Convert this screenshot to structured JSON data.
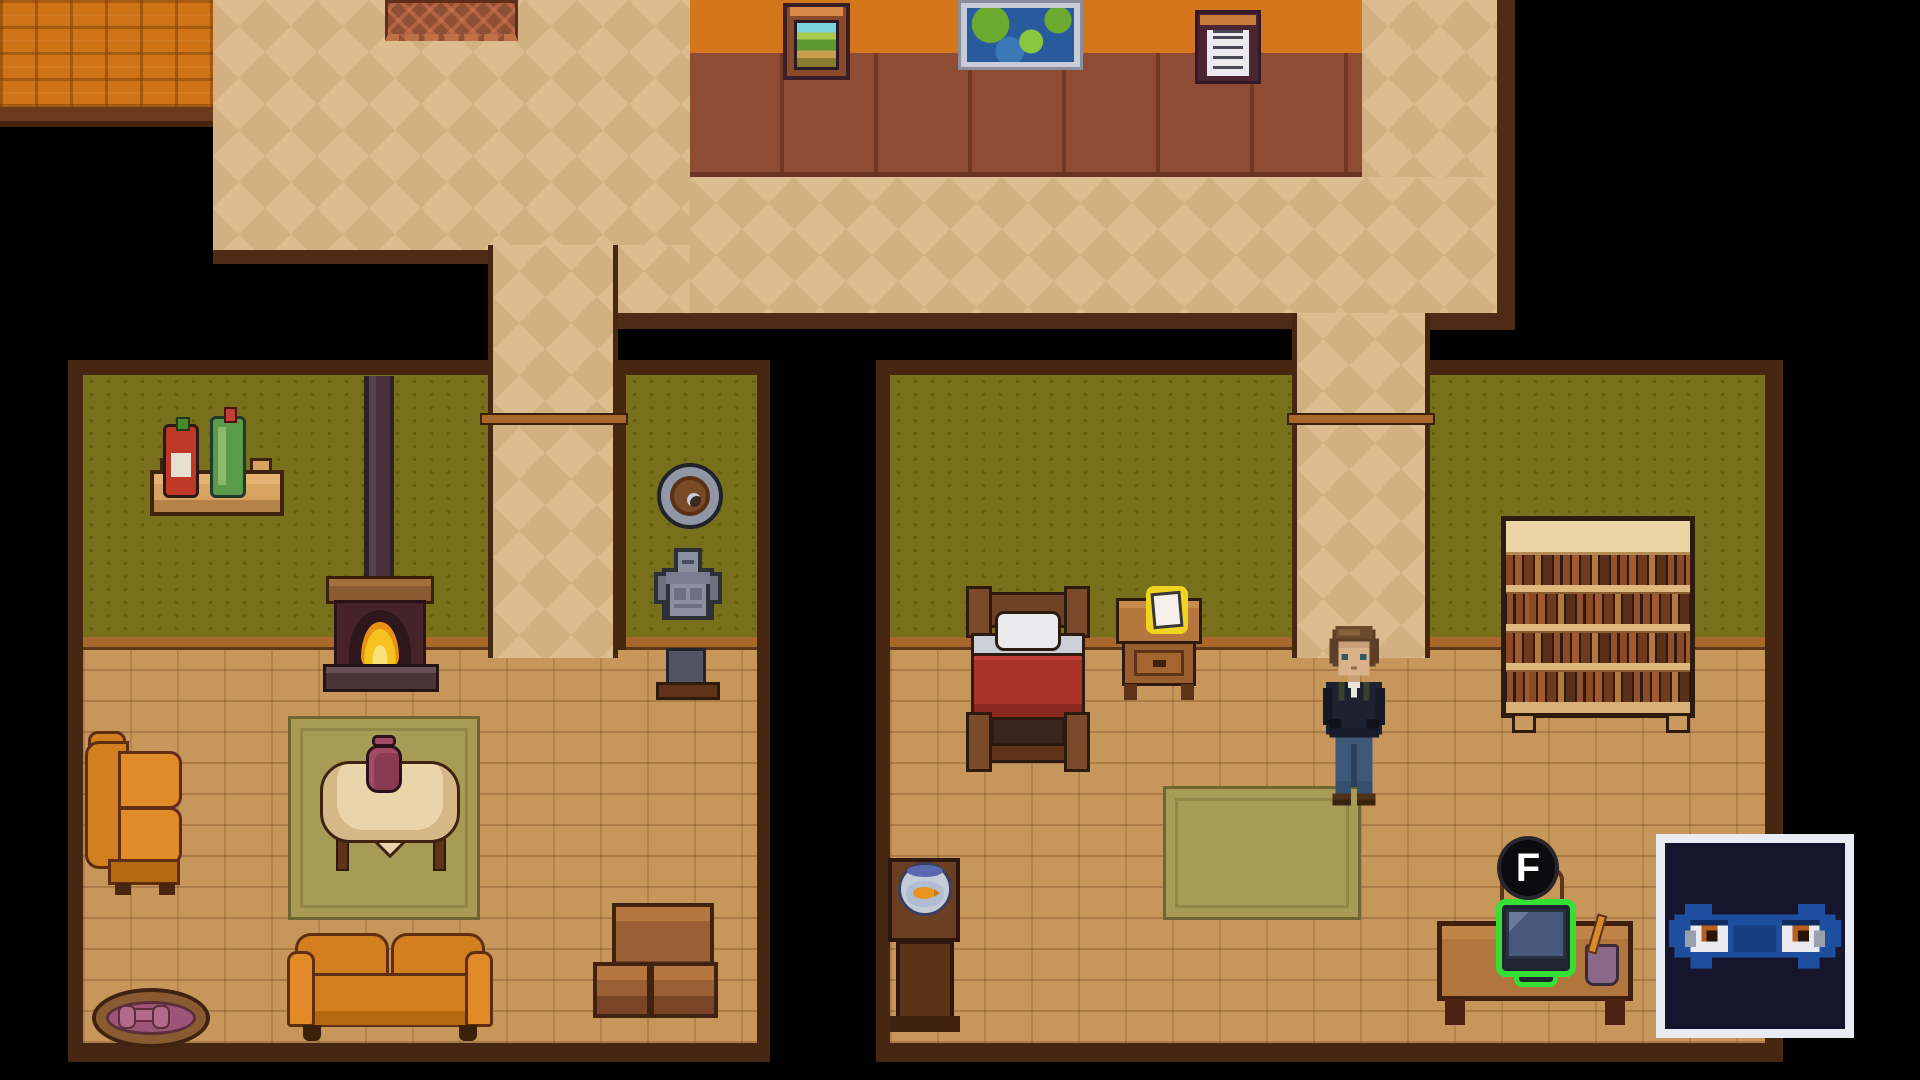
{
  "hud": {
    "interact_key_label": "F"
  },
  "scene": {
    "upper_hall": {
      "wall_pictures": [
        "landscape-painting",
        "world-map",
        "notice-board"
      ],
      "rug": "chevron-rug"
    },
    "living_room": {
      "furniture": [
        "wall-shelf",
        "red-bottle",
        "green-bottle",
        "stove-pipe",
        "wood-stove",
        "wall-shield",
        "bust-statue",
        "armchair",
        "area-rug",
        "round-table",
        "vase",
        "sofa",
        "pet-bed",
        "crate-stack"
      ]
    },
    "bedroom": {
      "furniture": [
        "bed",
        "nightstand",
        "glowing-note",
        "area-rug",
        "bookshelf",
        "fishbowl-stand",
        "fishbowl",
        "desk",
        "desk-chair",
        "computer",
        "pencil-cup"
      ],
      "highlighted_objects": [
        "glowing-note",
        "computer"
      ],
      "character": "player-character"
    },
    "stream_overlay": {
      "avatar": "ninja-eyes"
    }
  },
  "palette": {
    "background": "#000000",
    "hall_floor": "#ddbd8f",
    "wall_orange": "#d4771c",
    "wall_panel": "#8d4c33",
    "room_wall_green": "#79701c",
    "room_floor": "#c7965a",
    "trim_brown": "#4e2b15",
    "highlight_green": "#35e035",
    "note_glow": "#f0d520",
    "ninja_blue": "#1d4f9e"
  }
}
